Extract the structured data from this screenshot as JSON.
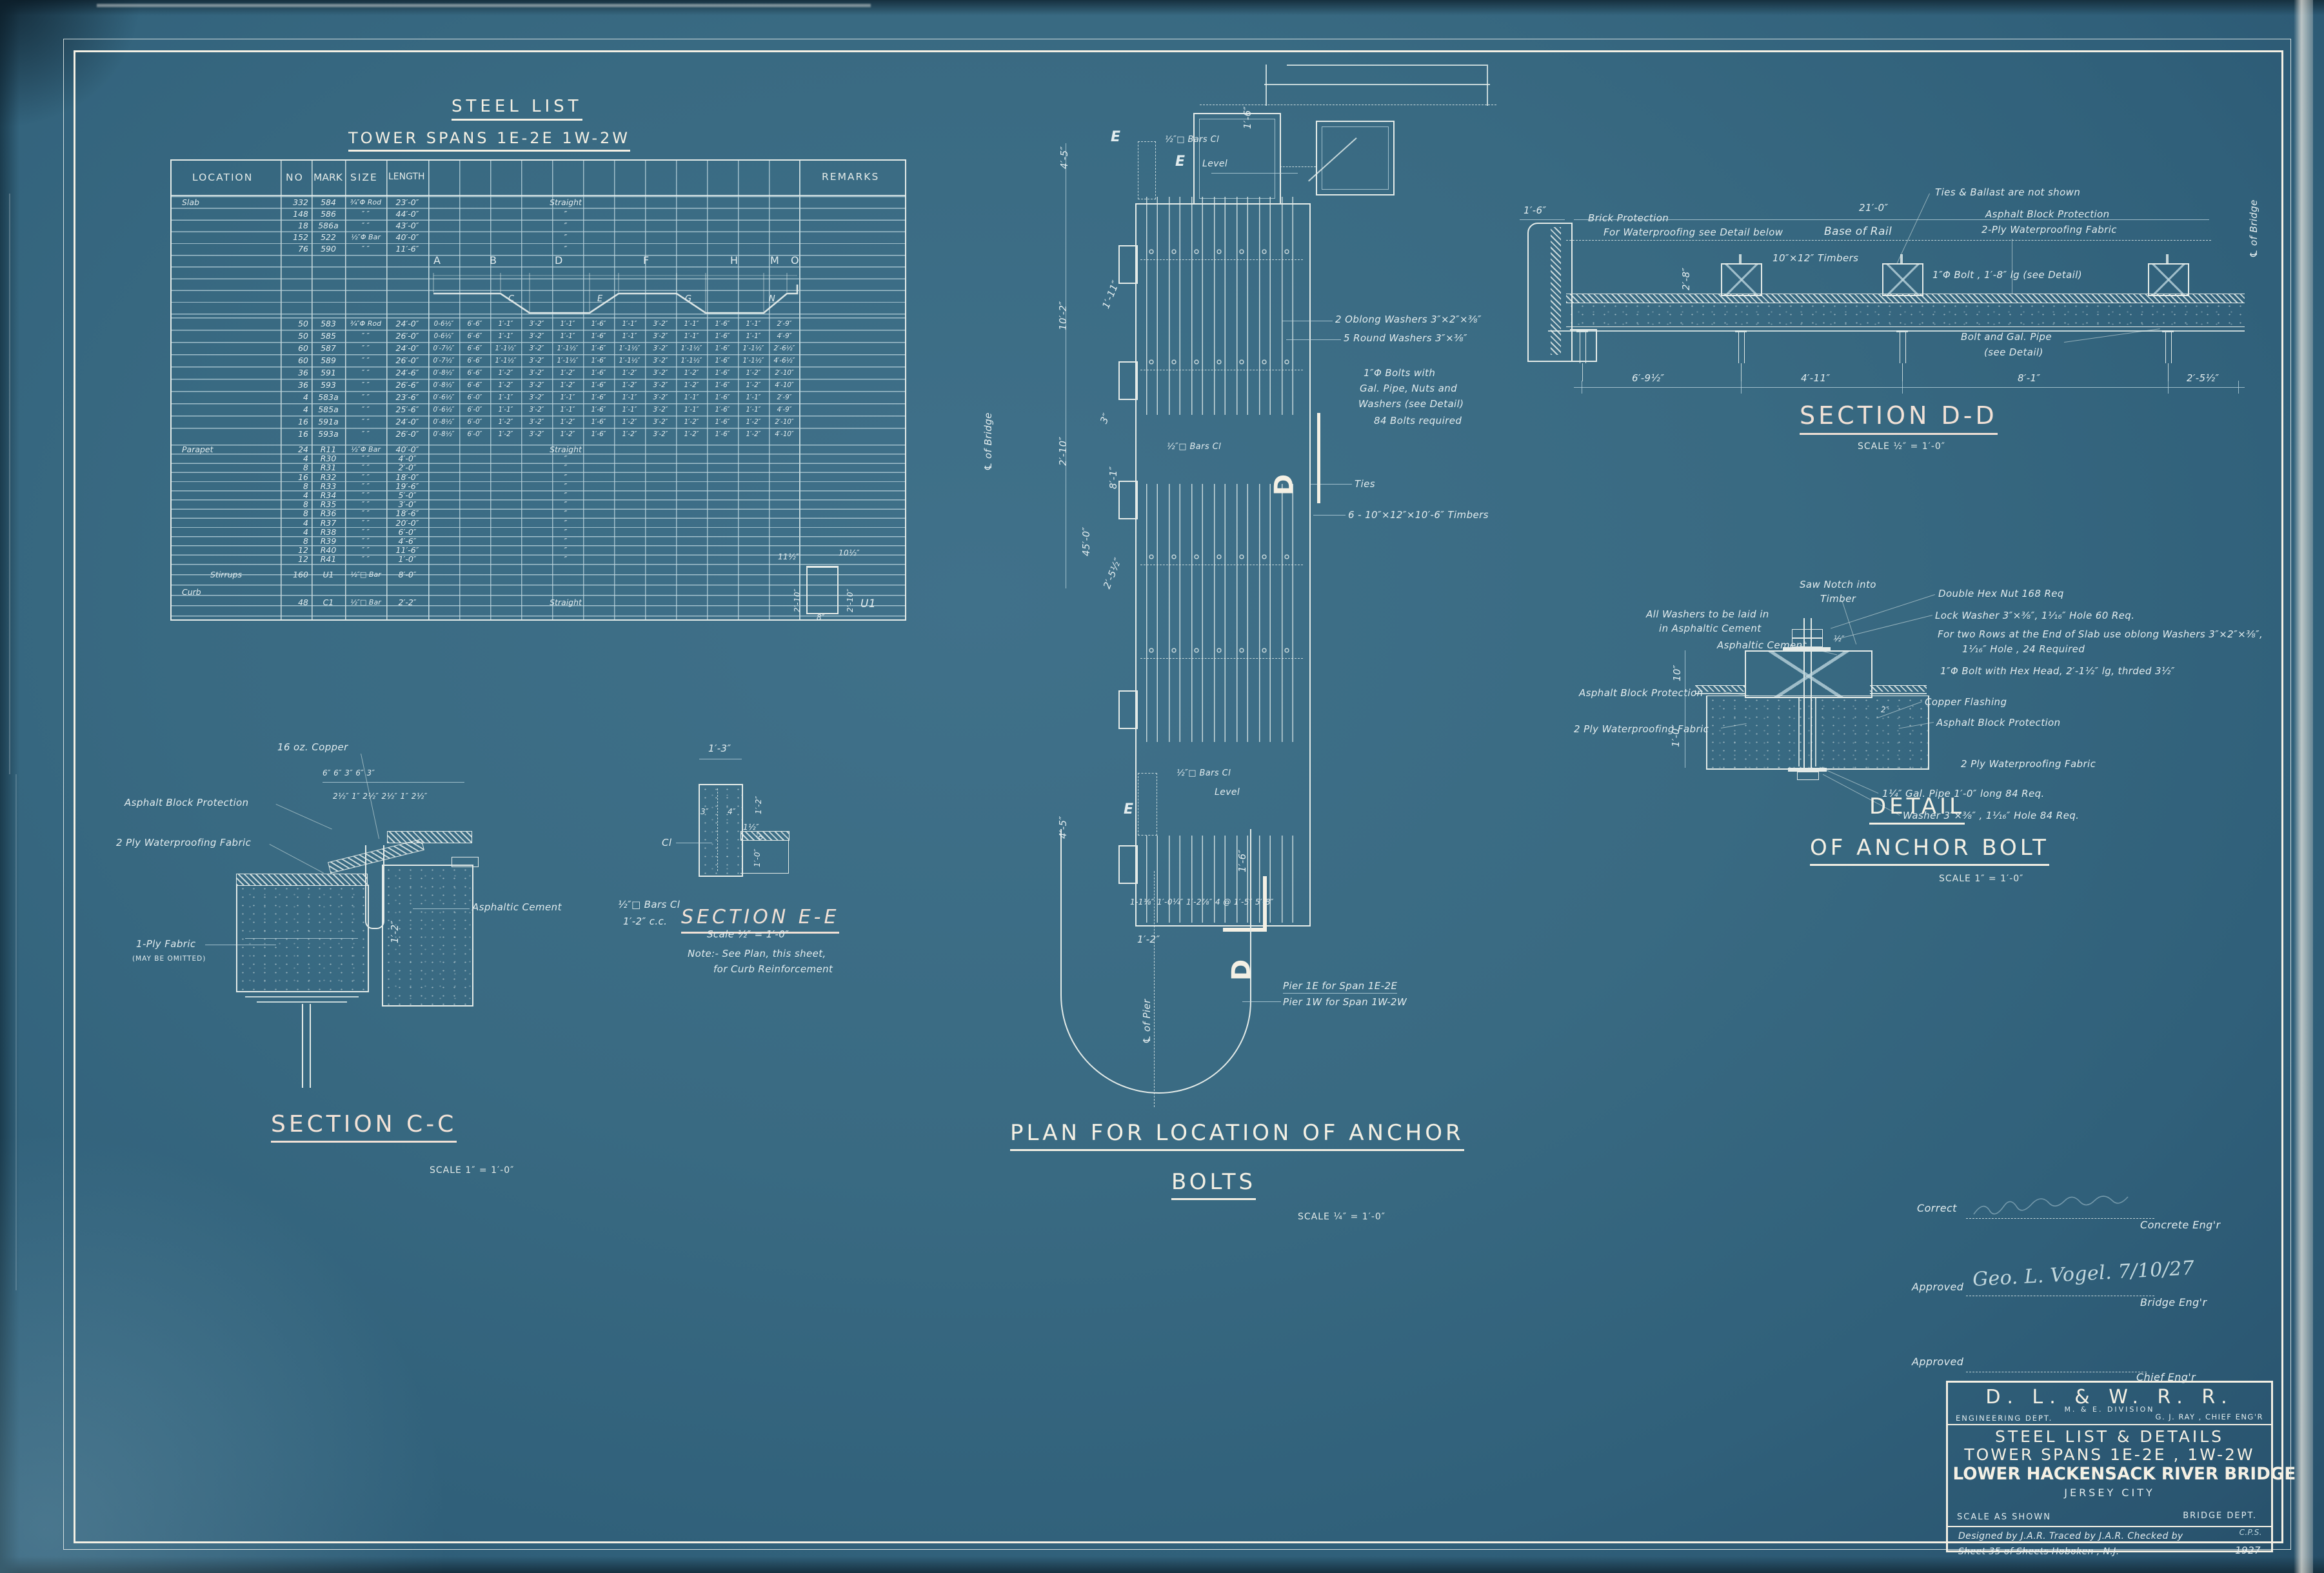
{
  "steel_list": {
    "title": "STEEL LIST",
    "subtitle": "TOWER SPANS 1E-2E 1W-2W",
    "headers": [
      "LOCATION",
      "NO",
      "MARK",
      "SIZE",
      "LENGTH",
      "REMARKS"
    ],
    "diagram_letters_top": [
      "A",
      "B",
      "D",
      "F",
      "H",
      "M",
      "O"
    ],
    "diagram_letters_diag": [
      "C",
      "E",
      "G",
      "N"
    ],
    "slab_rows": [
      [
        "Slab",
        "332",
        "584",
        "¾″Φ Rod",
        "23′-0″",
        "Straight"
      ],
      [
        "",
        "148",
        "586",
        "″    ″",
        "44′-0″",
        "″"
      ],
      [
        "",
        "18",
        "586a",
        "″    ″",
        "43′-0″",
        "″"
      ],
      [
        "",
        "152",
        "522",
        "½″Φ Bar",
        "40′-0″",
        "″"
      ],
      [
        "",
        "76",
        "590",
        "″    ″",
        "11′-6″",
        "″"
      ]
    ],
    "bent_rows": [
      [
        "",
        "50",
        "583",
        "¾″Φ Rod",
        "24′-0″",
        "0-6½″",
        "6′-6″",
        "1′-1″",
        "3′-2″",
        "1′-1″",
        "1′-6″",
        "1′-1″",
        "3′-2″",
        "1′-1″",
        "1′-6″",
        "1′-1″",
        "2′-9″"
      ],
      [
        "",
        "50",
        "585",
        "″  ″",
        "26′-0″",
        "0-6½″",
        "6′-6″",
        "1′-1″",
        "3′-2″",
        "1′-1″",
        "1′-6″",
        "1′-1″",
        "3′-2″",
        "1′-1″",
        "1′-6″",
        "1′-1″",
        "4′-9″"
      ],
      [
        "",
        "60",
        "587",
        "″  ″",
        "24′-0″",
        "0′-7½″",
        "6′-6″",
        "1′-1½″",
        "3′-2″",
        "1′-1½″",
        "1′-6″",
        "1′-1½″",
        "3′-2″",
        "1′-1½″",
        "1′-6″",
        "1′-1½″",
        "2′-6½″"
      ],
      [
        "",
        "60",
        "589",
        "″  ″",
        "26′-0″",
        "0′-7½″",
        "6′-6″",
        "1′-1½″",
        "3′-2″",
        "1′-1½″",
        "1′-6″",
        "1′-1½″",
        "3′-2″",
        "1′-1½″",
        "1′-6″",
        "1′-1½″",
        "4′-6½″"
      ],
      [
        "",
        "36",
        "591",
        "″  ″",
        "24′-6″",
        "0′-8½″",
        "6′-6″",
        "1′-2″",
        "3′-2″",
        "1′-2″",
        "1′-6″",
        "1′-2″",
        "3′-2″",
        "1′-2″",
        "1′-6″",
        "1′-2″",
        "2′-10″"
      ],
      [
        "",
        "36",
        "593",
        "″  ″",
        "26′-6″",
        "0′-8½″",
        "6′-6″",
        "1′-2″",
        "3′-2″",
        "1′-2″",
        "1′-6″",
        "1′-2″",
        "3′-2″",
        "1′-2″",
        "1′-6″",
        "1′-2″",
        "4′-10″"
      ],
      [
        "",
        "4",
        "583a",
        "″  ″",
        "23′-6″",
        "0′-6½″",
        "6′-0″",
        "1′-1″",
        "3′-2″",
        "1′-1″",
        "1′-6″",
        "1′-1″",
        "3′-2″",
        "1′-1″",
        "1′-6″",
        "1′-1″",
        "2′-9″"
      ],
      [
        "",
        "4",
        "585a",
        "″  ″",
        "25′-6″",
        "0′-6½″",
        "6′-0″",
        "1′-1″",
        "3′-2″",
        "1′-1″",
        "1′-6″",
        "1′-1″",
        "3′-2″",
        "1′-1″",
        "1′-6″",
        "1′-1″",
        "4′-9″"
      ],
      [
        "",
        "16",
        "591a",
        "″  ″",
        "24′-0″",
        "0′-8½″",
        "6′-0″",
        "1′-2″",
        "3′-2″",
        "1′-2″",
        "1′-6″",
        "1′-2″",
        "3′-2″",
        "1′-2″",
        "1′-6″",
        "1′-2″",
        "2′-10″"
      ],
      [
        "",
        "16",
        "593a",
        "″  ″",
        "26′-0″",
        "0′-8½″",
        "6′-0″",
        "1′-2″",
        "3′-2″",
        "1′-2″",
        "1′-6″",
        "1′-2″",
        "3′-2″",
        "1′-2″",
        "1′-6″",
        "1′-2″",
        "4′-10″"
      ]
    ],
    "parapet_rows": [
      [
        "Parapet",
        "24",
        "R11",
        "½″Φ Bar",
        "40′-0″",
        "Straight"
      ],
      [
        "",
        "4",
        "R30",
        "″   ″",
        "4′-0″",
        "″"
      ],
      [
        "",
        "8",
        "R31",
        "″   ″",
        "2′-0″",
        "″"
      ],
      [
        "",
        "16",
        "R32",
        "″   ″",
        "18′-0″",
        "″"
      ],
      [
        "",
        "8",
        "R33",
        "″   ″",
        "19′-6″",
        "″"
      ],
      [
        "",
        "4",
        "R34",
        "″   ″",
        "5′-0″",
        "″"
      ],
      [
        "",
        "8",
        "R35",
        "″   ″",
        "3′-0″",
        "″"
      ],
      [
        "",
        "8",
        "R36",
        "″   ″",
        "18′-6″",
        "″"
      ],
      [
        "",
        "4",
        "R37",
        "″   ″",
        "20′-0″",
        "″"
      ],
      [
        "",
        "4",
        "R38",
        "″   ″",
        "6′-0″",
        "″"
      ],
      [
        "",
        "8",
        "R39",
        "″   ″",
        "4′-6″",
        "″"
      ],
      [
        "",
        "12",
        "R40",
        "″   ″",
        "11′-6″",
        "″"
      ],
      [
        "",
        "12",
        "R41",
        "″   ″",
        "1′-0″",
        "″"
      ]
    ],
    "stirrup_rows": [
      [
        "Stirrups",
        "160",
        "U1",
        "½″□ Bar",
        "8′-0″",
        ""
      ]
    ],
    "curb_rows": [
      [
        "Curb",
        "",
        "",
        "",
        "",
        ""
      ],
      [
        "",
        "48",
        "C1",
        "½″□ Bar",
        "2′-2″",
        "Straight"
      ]
    ],
    "stirrup_diagram": {
      "top_left": "11½″",
      "top_right": "10½″",
      "left": "2′-10″",
      "right": "2′-10″",
      "bottom": "8″",
      "mark": "U1"
    }
  },
  "plan": {
    "title_line1": "PLAN FOR LOCATION OF ANCHOR",
    "title_line2": "BOLTS",
    "scale": "SCALE ¼″ = 1′-0″",
    "labels": {
      "e": "E",
      "d": "D",
      "level": "Level",
      "bars_cl": "½″□ Bars Cl",
      "ties": "Ties",
      "washers_oblong": "2 Oblong Washers 3″×2″×⅜″",
      "washers_round": "5 Round Washers 3″×⅜″",
      "bolts1": "1″Φ Bolts with",
      "bolts2": "Gal. Pipe, Nuts and",
      "bolts3": "Washers        (see Detail)",
      "bolts4": "84 Bolts required",
      "timbers": "6 - 10″×12″×10′-6″ Timbers",
      "cl_bridge": "℄ of Bridge",
      "cl_pier": "℄ of Pier",
      "pier_note1": "Pier 1E for Span 1E-2E",
      "pier_note2": "Pier 1W for Span 1W-2W",
      "dims_bottom": "1-1⅛″ 1′-0¼″ 1′-2⅞″  4 @ 1′-5″  5′-8″",
      "dim_4_5": "4′-5″",
      "dim_10_2": "10′-2″",
      "dim_1_11": "1′-11″",
      "dim_2_10": "2′-10″",
      "dim_3": "3″",
      "dim_8_1": "8′-1″",
      "dim_45_0": "45′-0″",
      "dim_2_5h": "2′-5½″",
      "dim_1_2": "1′-2″",
      "dim_1_6": "1′-6″"
    }
  },
  "section_dd": {
    "title": "SECTION D-D",
    "scale": "SCALE ½″ = 1′-0″",
    "labels": {
      "ties_note": "Ties & Ballast are not shown",
      "dim_21": "21′-0″",
      "dim_1_6": "1′-6″",
      "dim_2_8": "2′-8″",
      "brick1": "Brick Protection",
      "brick2": "For Waterproofing see Detail below",
      "base_rail": "Base of Rail",
      "asphalt": "Asphalt Block Protection",
      "fabric": "2-Ply Waterproofing Fabric",
      "timbers": "10″×12″ Timbers",
      "bolt": "1″Φ Bolt , 1′-8″ lg (see Detail)",
      "bolt_pipe1": "Bolt and Gal. Pipe",
      "bolt_pipe2": "(see Detail)",
      "cl_bridge": "℄ of Bridge",
      "dim_6_9": "6′-9½″",
      "dim_4_11": "4′-11″",
      "dim_8_1": "8′-1″",
      "dim_2_5": "2′-5½″"
    }
  },
  "anchor_detail": {
    "title1": "DETAIL",
    "title2": "OF ANCHOR BOLT",
    "scale": "SCALE 1″ = 1′-0″",
    "labels": {
      "saw1": "Saw Notch into",
      "saw2": "Timber",
      "hex": "Double Hex Nut  168 Req",
      "washers1": "All Washers to be laid in",
      "washers2": "in Asphaltic Cement",
      "lock": "Lock Washer 3″×⅜″, 1¹⁄₁₆″ Hole  60 Req.",
      "oblong1": "For two Rows at the End of Slab use oblong Washers 3″×2″×⅜″,",
      "oblong2": "1¹⁄₁₆″ Hole , 24 Required",
      "cement": "Asphaltic Cement",
      "bolt": "1″Φ Bolt with Hex Head, 2′-1½″ lg, thrded 3½″",
      "asphalt_l": "Asphalt Block Protection",
      "copper": "Copper Flashing",
      "asphalt_r": "Asphalt Block Protection",
      "fabric_l": "2 Ply Waterproofing Fabric",
      "fabric_r": "2 Ply Waterproofing Fabric",
      "pipe": "1¼″ Gal. Pipe 1′-0″ long  84 Req.",
      "washer": "Washer 3″×⅜″ , 1¹⁄₁₆″ Hole  84 Req.",
      "dim_half": "½″",
      "dim_2": "2″",
      "dim_10": "10″",
      "dim_1_0": "1′-0″"
    }
  },
  "section_cc": {
    "title": "SECTION C-C",
    "scale": "SCALE 1″ = 1′-0″",
    "labels": {
      "copper": "16 oz. Copper",
      "dims_top": "6″     6″    3″     6″    3″",
      "dims_fr": "2½″ 1″ 2½″    2½″ 1″ 2½″",
      "asphalt": "Asphalt Block Protection",
      "fabric": "2 Ply Waterproofing Fabric",
      "oneply1": "1-Ply Fabric",
      "oneply2": "(MAY BE OMITTED)",
      "cement": "Asphaltic Cement",
      "bars1": "½″□ Bars Cl",
      "bars2": "1′-2″ c.c.",
      "dim_1_2": "1′-2″"
    }
  },
  "section_ee": {
    "title": "SECTION E-E",
    "scale": "Scale ½″ = 1′-0″",
    "note1": "Note:- See Plan, this sheet,",
    "note2": "for Curb Reinforcement",
    "labels": {
      "dim_1_3": "1′-3″",
      "dim_3": "3″",
      "dim_4": "4″",
      "dim_1_2": "1′-2″",
      "dim_6": "6″",
      "dim_1_0": "1′-0″",
      "dim_1h": "1½″",
      "cl": "Cl"
    }
  },
  "signatures": {
    "correct": "Correct",
    "concrete": "Concrete Eng'r",
    "approved1": "Approved",
    "sig1": "Geo. L. Vogel.  7/10/27",
    "bridge": "Bridge Eng'r",
    "approved2": "Approved",
    "chief": "Chief Eng'r"
  },
  "title_block": {
    "railroad": "D.  L.  &  W.  R.  R.",
    "division": "M. & E.  DIVISION",
    "dept": "ENGINEERING  DEPT.",
    "chief": "G. J. RAY , CHIEF  ENG'R",
    "line1": "STEEL LIST & DETAILS",
    "line2": "TOWER SPANS 1E-2E , 1W-2W",
    "line3": "LOWER HACKENSACK RIVER BRIDGE",
    "line4": "JERSEY    CITY",
    "scale": "SCALE AS SHOWN",
    "dept2": "BRIDGE  DEPT.",
    "credits": "Designed by J.A.R.    Traced by J.A.R.    Checked by",
    "checker": "C.P.S.",
    "sheet": "Sheet 35 of       Sheets    Hoboken , N.J.",
    "year": "1927"
  }
}
